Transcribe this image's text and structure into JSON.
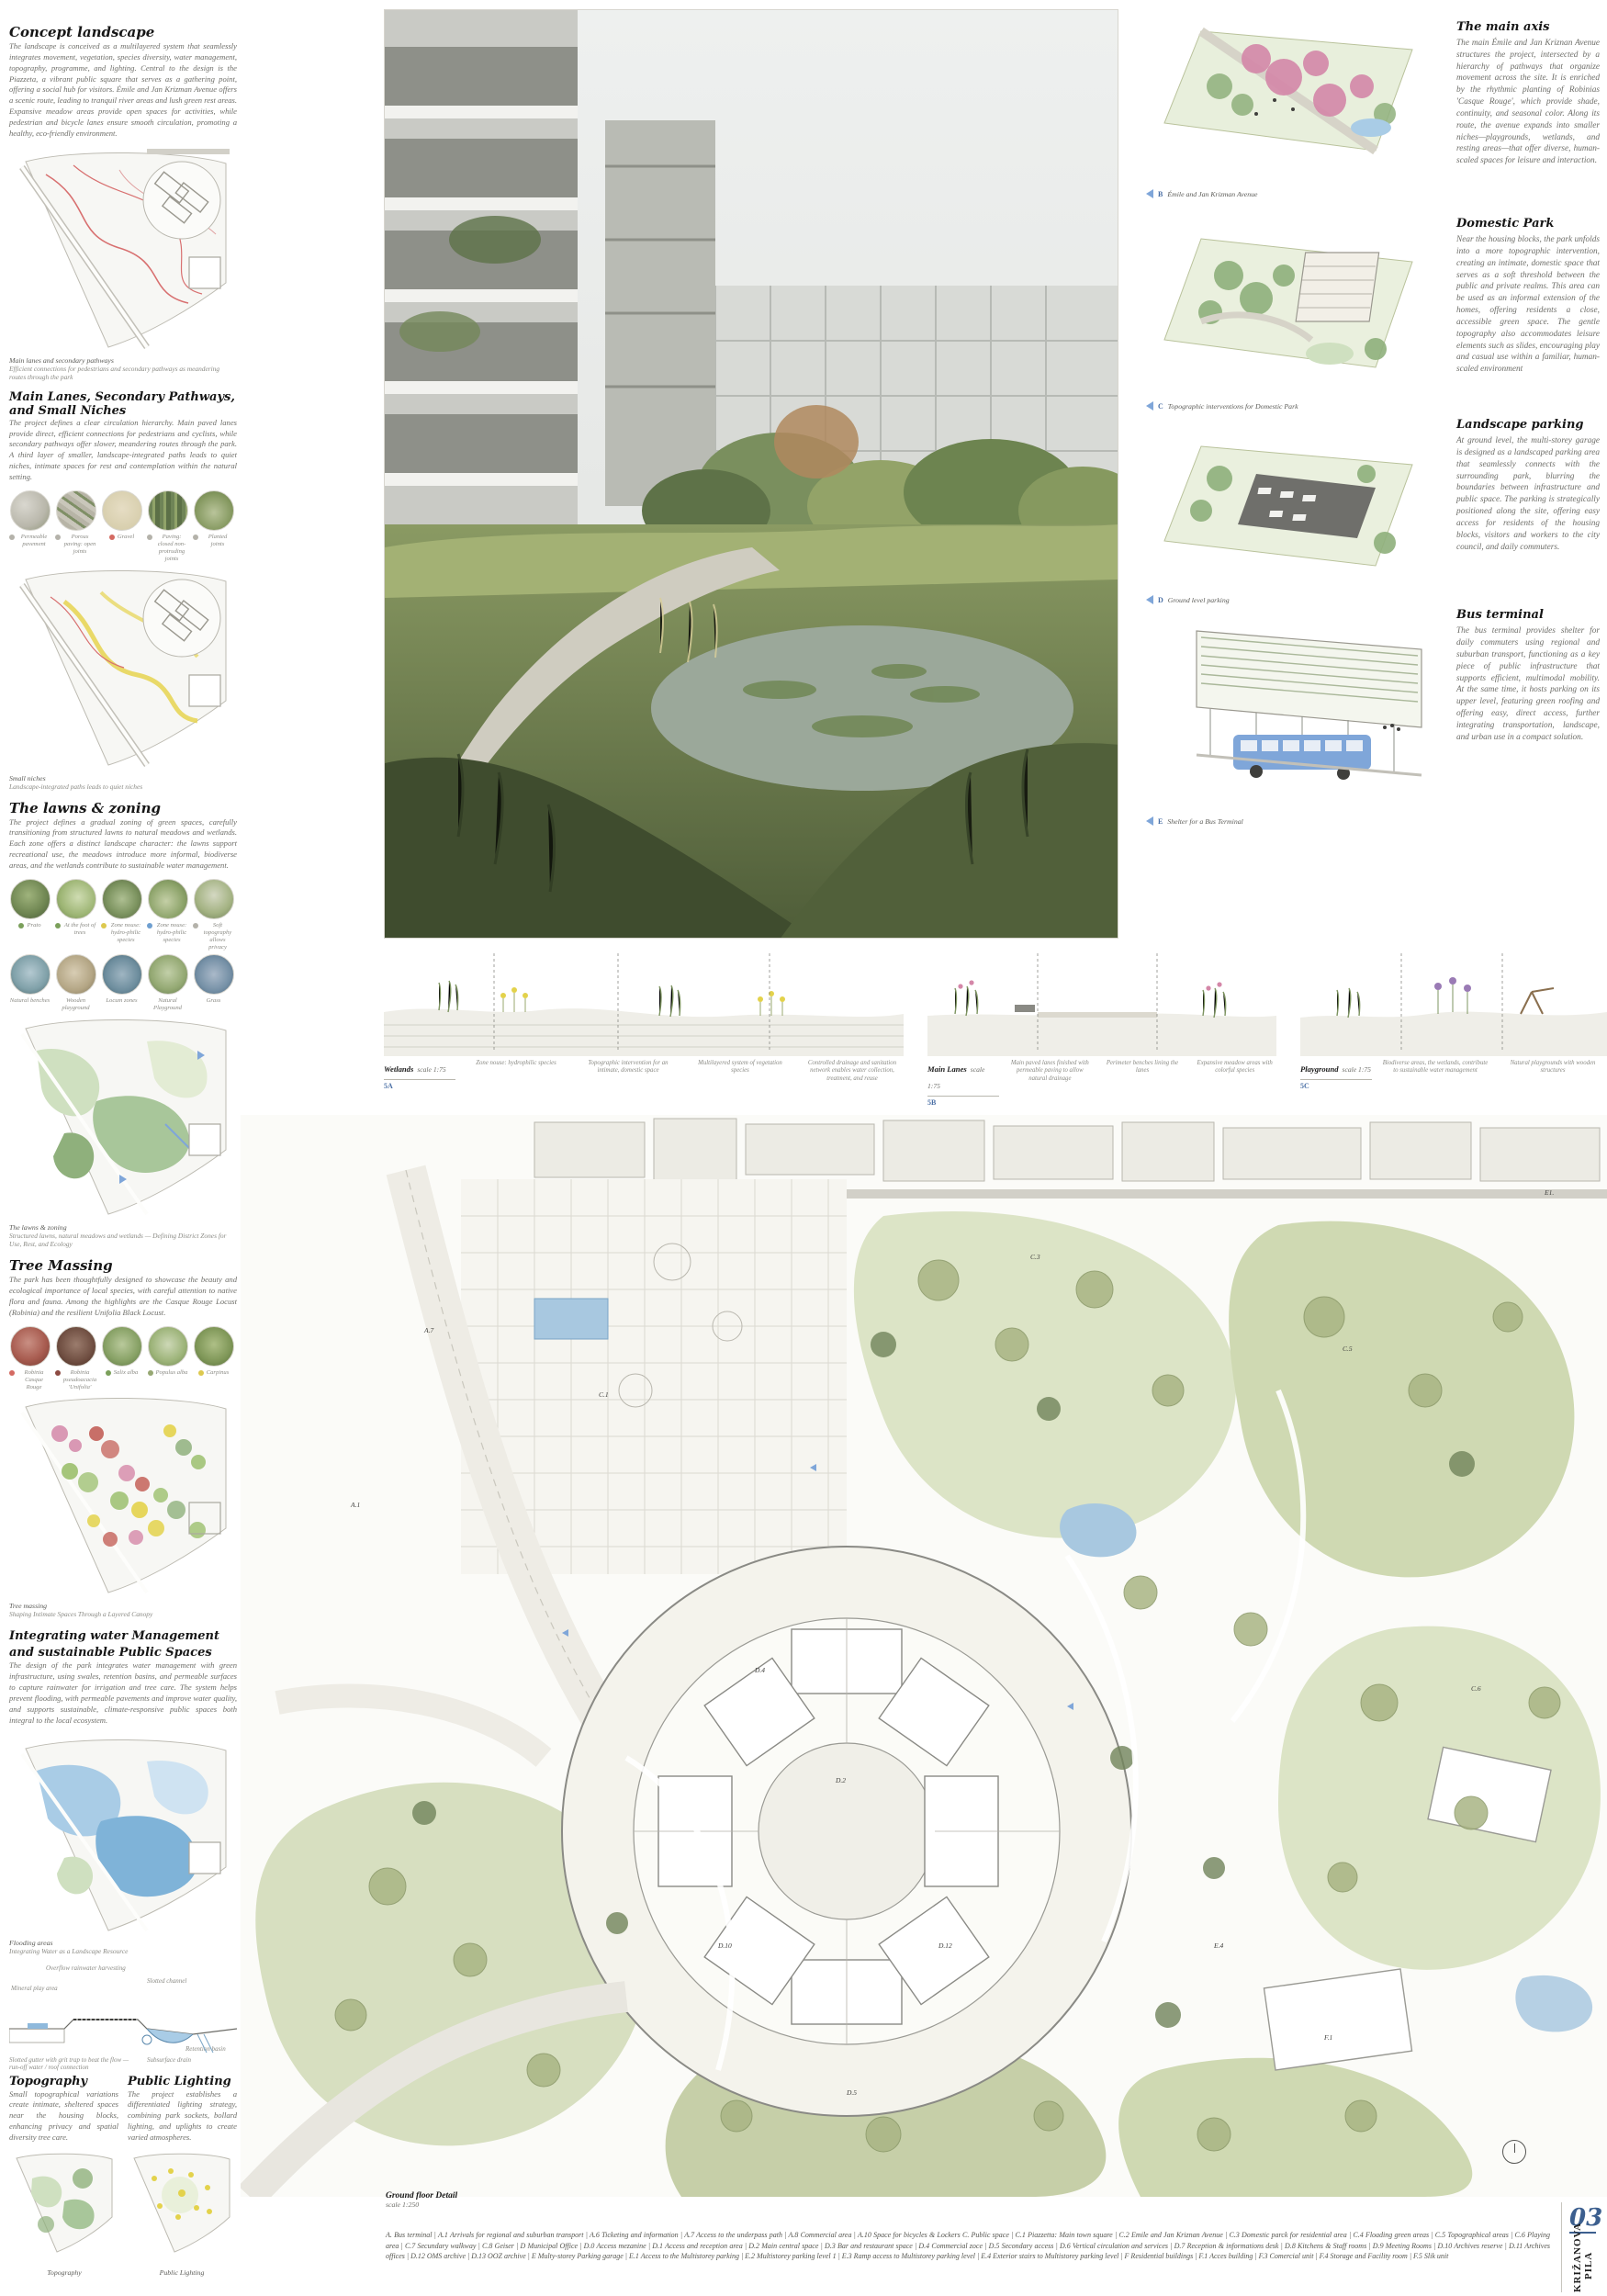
{
  "board": {
    "number": "03",
    "project": "KRIŽANOVA PILA"
  },
  "colors": {
    "accent_blue": "#4a6fa5",
    "path_red": "#d87070",
    "path_yellow": "#e6d34f",
    "water_blue": "#8fb9dc",
    "olive_green": "#b9c29b"
  },
  "left": {
    "concept": {
      "title": "Concept landscape",
      "body": "The landscape is conceived as a multilayered system that seamlessly integrates movement, vegetation, species diversity, water management, topography, programme, and lighting. Central to the design is the Piazzeta, a vibrant public square that serves as a gathering point, offering a social hub for visitors. Émile and Jan Krizman Avenue offers a scenic route, leading to tranquil river areas and lush green rest areas. Expansive meadow areas provide open spaces for activities, while pedestrian and bicycle lanes ensure smooth circulation, promoting a healthy, eco-friendly environment."
    },
    "fig_main_lanes": {
      "caption": "Main lanes and secondary pathways",
      "subcaption": "Efficient connections for pedestrians and secondary pathways as meandering routes through the park"
    },
    "lanes": {
      "title": "Main Lanes, Secondary Pathways, and Small Niches",
      "body": "The project defines a clear circulation hierarchy. Main paved lanes provide direct, efficient connections for pedestrians and cyclists, while secondary pathways offer slower, meandering routes through the park. A third layer of smaller, landscape-integrated paths leads to quiet niches, intimate spaces for rest and contemplation within the natural setting."
    },
    "materials": [
      "Permeable pavement",
      "Porous paving: open joints",
      "Gravel",
      "Paving: closed non-protruding joints",
      "Planted joints"
    ],
    "fig_small_niches": {
      "caption": "Small niches",
      "subcaption": "Landscape-integrated paths leads to quiet niches"
    },
    "lawns": {
      "title": "The lawns & zoning",
      "body": "The project defines a gradual zoning of green spaces, carefully transitioning from structured lawns to natural meadows and wetlands. Each zone offers a distinct landscape character: the lawns support recreational use, the meadows introduce more informal, biodiverse areas, and the wetlands contribute to sustainable water management."
    },
    "zones_row1": [
      "Prato",
      "At the foot of trees",
      "Zone nouse: hydro-philic species",
      "Zone nouse: hydro-philic species",
      "Soft topography allows privacy"
    ],
    "zones_row2": [
      "Natural benches",
      "Wooden playground",
      "Locum zones",
      "Natural Playground",
      "Grass"
    ],
    "fig_lawns": {
      "caption": "The lawns & zoning",
      "subcaption": "Structured lawns, natural meadows and wetlands — Defining District Zones for Use, Rest, and Ecology"
    },
    "trees": {
      "title": "Tree Massing",
      "body": "The park has been thoughtfully designed to showcase the beauty and ecological importance of local species, with careful attention to native flora and fauna. Among the highlights are the Casque Rouge Locust (Robinia) and the resilient Unifolia Black Locust."
    },
    "tree_species": [
      "Robinia Casque Rouge",
      "Robinia pseudoacacia 'Unifolia'",
      "Salix alba",
      "Populus alba",
      "Carpinus"
    ],
    "fig_tree_massing": {
      "caption": "Tree massing",
      "subcaption": "Shaping Intimate Spaces Through a Layered Canopy"
    },
    "water": {
      "title": "Integrating water Management and sustainable Public Spaces",
      "body": "The design of the park integrates water management with green infrastructure, using swales, retention basins, and permeable surfaces to capture rainwater for irrigation and tree care. The system helps prevent flooding, with permeable pavements and improve water quality, and supports sustainable, climate-responsive public spaces both integral to the local ecosystem."
    },
    "fig_flooding": {
      "caption": "Flooding areas",
      "subcaption": "Integrating Water as a Landscape Resource"
    },
    "water_section_labels": [
      "Overflow rainwater harvesting",
      "Mineral play area",
      "Slotted channel",
      "Retention basin",
      "Subsurface drain",
      "Slotted gutter with grit trap to beat the flow — run-off water / roof connection"
    ],
    "topography": {
      "title": "Topography",
      "body": "Small topographical variations create intimate, sheltered spaces near the housing blocks, enhancing privacy and spatial diversity tree care."
    },
    "lighting": {
      "title": "Public Lighting",
      "body": "The project establishes a differentiated lighting strategy, combining park sockets, bollard lighting, and uplights to create varied atmospheres."
    },
    "mini_plans": {
      "left_caption": "Topography",
      "right_caption": "Public Lighting"
    }
  },
  "axons": [
    {
      "marker": "B",
      "caption": "Émile and Jan Krizman Avenue"
    },
    {
      "marker": "C",
      "caption": "Topographic interventions for Domestic Park"
    },
    {
      "marker": "D",
      "caption": "Ground level parking"
    },
    {
      "marker": "E",
      "caption": "Shelter for a Bus Terminal"
    }
  ],
  "right_texts": [
    {
      "title": "The main axis",
      "body": "The main Émile and Jan Kriznan Avenue structures the project, intersected by a hierarchy of pathways that organize movement across the site. It is enriched by the rhythmic planting of Robinias 'Casque Rouge', which provide shade, continuity, and seasonal color. Along its route, the avenue expands into smaller niches—playgrounds, wetlands, and resting areas—that offer diverse, human-scaled spaces for leisure and interaction."
    },
    {
      "title": "Domestic Park",
      "body": "Near the housing blocks, the park unfolds into a more topographic intervention, creating an intimate, domestic space that serves as a soft threshold between the public and private realms. This area can be used as an informal extension of the homes, offering residents a close, accessible green space. The gentle topography also accommodates leisure elements such as slides, encouraging play and casual use within a familiar, human-scaled environment"
    },
    {
      "title": "Landscape parking",
      "body": "At ground level, the multi-storey garage is designed as a landscaped parking area that seamlessly connects with the surrounding park, blurring the boundaries between infrastructure and public space. The parking is strategically positioned along the site, offering easy access for residents of the housing blocks, visitors and workers to the city council, and daily commuters."
    },
    {
      "title": "Bus terminal",
      "body": "The bus terminal provides shelter for daily commuters using regional and suburban transport, functioning as a key piece of public infrastructure that supports efficient, multimodal mobility. At the same time, it hosts parking on its upper level, featuring green roofing and offering easy, direct access, further integrating transportation, landscape, and urban use in a compact solution."
    }
  ],
  "sections": [
    {
      "name": "Wetlands",
      "scale": "scale 1:75",
      "ref": "5A",
      "labels": [
        "Zone nouse: hydrophilic species",
        "Topographic intervention for an intimate, domestic space",
        "Multilayered system of vegetation species",
        "Controlled drainage and sanitation network enables water collection, treatment, and reuse"
      ]
    },
    {
      "name": "Main Lanes",
      "scale": "scale 1:75",
      "ref": "5B",
      "labels": [
        "Main paved lanes finished with permeable paving to allow natural drainage",
        "Perimeter benches lining the lanes",
        "Expansive meadow areas with colorful species"
      ]
    },
    {
      "name": "Playground",
      "scale": "scale 1:75",
      "ref": "5C",
      "labels": [
        "Biodiverse areas, the wetlands, contribute to sustainable water management",
        "Natural playgrounds with wooden structures"
      ]
    }
  ],
  "plan": {
    "caption": "Ground floor Detail",
    "scale": "scale 1:250",
    "labels": [
      "A.1",
      "A.7",
      "C.1",
      "C.3",
      "C.5",
      "C.6",
      "D.2",
      "D.4",
      "D.10",
      "D.12",
      "D.5",
      "E.4",
      "F.1",
      "E1."
    ]
  },
  "legend": {
    "line": "A. Bus terminal | A.1 Arrivals for regional and suburban transport | A.6 Ticketing and information | A.7 Access to the underpass path | A.8 Commercial area | A.10 Space for bicycles & Lockers C. Public space | C.1 Piazzetta: Main town square | C.2 Emile and Jan Kriznan Avenue | C.3 Domestic parck for residential area | C.4 Floading green areas | C.5 Topographical areas | C.6 Playing area | C.7 Secundary walkway | C.8 Geiser | D Municipal Office | D.0 Access mezanine | D.1 Access and reception area | D.2 Main central space | D.3 Bar and restaurant space | D.4 Commercial zoce | D.5 Secondary access | D.6 Vertical circulation and services | D.7 Reception & informations desk | D.8 Kitchens & Staff rooms | D.9 Meeting Rooms | D.10 Archives reserve | D.11 Archives offices | D.12 OMS archive | D.13 OOZ archive | E Multy-storey Parking garage | E.1 Access to the Multistorey parking | E.2 Multistorey parking level 1 | E.3 Ramp access to Multistorey parking level | E.4 Exterior stairs to Multistorey parking level | F Residential buildings | F.1 Acces building | F.3 Comercial unit | F.4 Storage and Facility room | F.5 Slik unit"
  }
}
